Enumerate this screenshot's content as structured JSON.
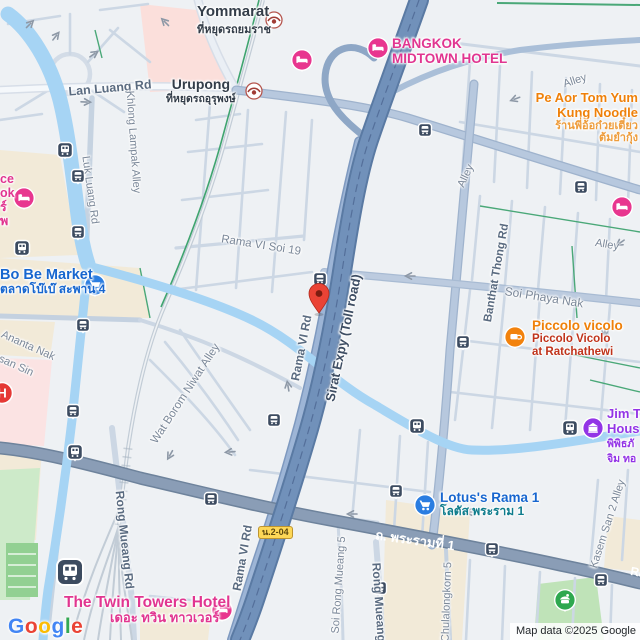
{
  "map_type": "street-map",
  "attribution": "Map data ©2025 Google",
  "logo": {
    "l1": "G",
    "l2": "o",
    "l3": "o",
    "l4": "g",
    "l5": "l",
    "l6": "e"
  },
  "badge_route": "น.2-04",
  "marker": {
    "kind": "red-destination-pin",
    "x": 319,
    "y": 313
  },
  "colors": {
    "background": "#eef1f4",
    "water": "#a6d4f4",
    "expressway": "#7191ba",
    "major_road": "#8a9db6",
    "secondary_road": "#9db5d6",
    "minor_road": "#ccd7e4",
    "beige_area": "#f2ead8",
    "pink_area": "#fbdfdb",
    "hospital_area": "#fbe3e3",
    "green_area": "#cdeac9",
    "park": "#bfe3b8",
    "railway": "#c3ccd6",
    "rail_green": "#3fa46f",
    "hotel_pink": "#e8368f",
    "shopping_blue": "#1766cf",
    "food_orange": "#ef8009",
    "museum_purple": "#9334e6",
    "transit_navy": "#3c4b60",
    "marker_red": "#ea4335",
    "badge_yellow": "#fdd757"
  },
  "icons": {
    "hotel": "bed",
    "market": "shopping-cart",
    "cafe": "coffee-cup",
    "museum": "building",
    "hospital": "H",
    "park": "pavilion",
    "bus_stop": "bus",
    "train_stop": "train",
    "srt_stop": "railway-emblem",
    "marker": "pin"
  },
  "stations": {
    "yommarat": {
      "name": "Yommarat",
      "thai": "ที่หยุดรถยมราช"
    },
    "urupong": {
      "name": "Urupong",
      "thai": "ที่หยุดรถอุรุพงษ์"
    }
  },
  "pois": {
    "bangkok_midtown": {
      "line1": "BANGKOK",
      "line2": "MIDTOWN HOTEL"
    },
    "pe_aor": {
      "line1": "Pe Aor Tom Yum",
      "line2": "Kung Noodle",
      "thai1": "ร้านพี่อ้อก๋วยเตี๋ยว",
      "thai2": "ต้มยำกุ้ง"
    },
    "bo_be": {
      "name": "Bo Be Market",
      "thai": "ตลาดโบ๊เบ๊ สะพาน 4"
    },
    "piccolo": {
      "name": "Piccolo vicolo",
      "sub1": "Piccolo Vicolo",
      "sub2": "at Ratchathewi"
    },
    "jim_thompson": {
      "line1": "Jim T",
      "line2": "Hous",
      "thai1": "พิพิธภั",
      "thai2": "จิม ทอ"
    },
    "lotus": {
      "name": "Lotus's Rama 1",
      "thai": "โลตัส พระราม 1"
    },
    "twin_towers": {
      "name": "The Twin Towers Hotel",
      "thai": "เดอะ ทวิน ทาวเวอร์"
    },
    "edge_hotel_fragment": {
      "l1": "ce",
      "l2": "ok",
      "l3": "ร์",
      "l4": "พ"
    },
    "hospital_letter": "H"
  },
  "roads": {
    "lan_luang": "Lan Luang Rd",
    "luk_luang": "Luk Luang Rd",
    "khlong_lampak": "Khlong Lampak Alley",
    "rama_vi": "Rama VI Rd",
    "rama_vi_soi19": "Rama VI Soi 19",
    "sirat": "Sirat Expy (Toll road)",
    "banthat_thong": "Banthat Thong Rd",
    "soi_phaya_nak": "Soi Phaya Nak",
    "alley": "Alley",
    "wat_borom": "Wat Borom Niwat Alley",
    "ananta_nak": "Ananta Nak",
    "san_sin": "san Sin",
    "rong_mueang": "Rong Mueang Rd",
    "soi_rong_mueang5": "Soi Rong Mueang 5",
    "chulalongkorn5": "Chulalongkorn 5",
    "kasem_san2": "Kasem San 2 Alley",
    "rama1_thai": "ถ. พระรามที่ 1",
    "rama1_en": "Rama I Rd"
  }
}
